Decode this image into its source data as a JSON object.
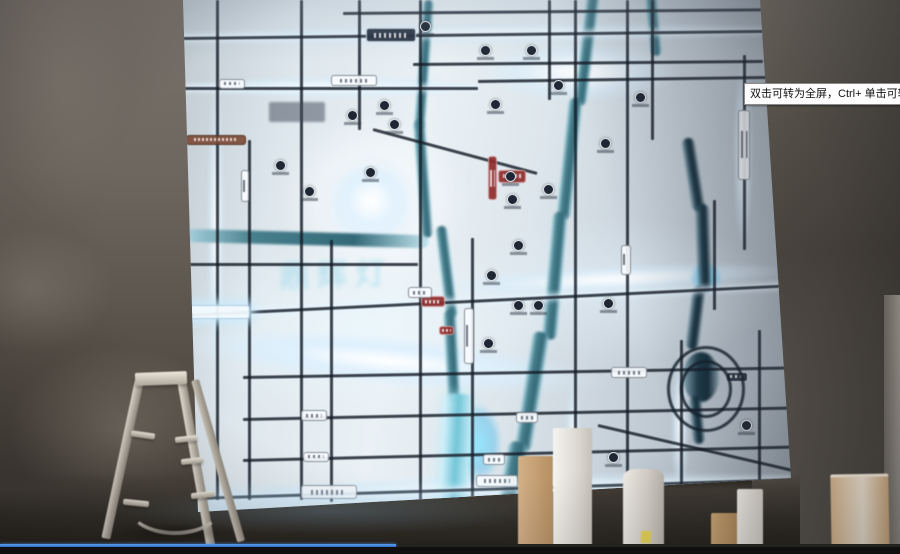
{
  "overlay": {
    "tooltip_text": "双击可转为全屏，Ctrl+ 单击可转为"
  },
  "player": {
    "progress_percent": 44,
    "progress_color": "#3f86e0"
  },
  "map": {
    "watermark": "鼎辉灯",
    "roads": [
      {
        "x": 160,
        "y": 12,
        "len": 420,
        "dir": "h",
        "rot": -0.5
      },
      {
        "x": 0,
        "y": 37,
        "len": 580,
        "dir": "h",
        "rot": -0.7,
        "glow": true
      },
      {
        "x": 230,
        "y": 63,
        "len": 350,
        "dir": "h",
        "rot": -0.5
      },
      {
        "x": 0,
        "y": 87,
        "len": 295,
        "dir": "h",
        "glow": true
      },
      {
        "x": 295,
        "y": 80,
        "len": 290,
        "dir": "h",
        "rot": -0.8
      },
      {
        "x": 0,
        "y": 263,
        "len": 235,
        "dir": "h"
      },
      {
        "x": 0,
        "y": 314,
        "len": 608,
        "dir": "h",
        "rot": -2.8,
        "glow": true
      },
      {
        "x": 60,
        "y": 376,
        "len": 548,
        "dir": "h",
        "rot": -1
      },
      {
        "x": 60,
        "y": 418,
        "len": 548,
        "dir": "h",
        "rot": -1.2
      },
      {
        "x": 60,
        "y": 459,
        "len": 548,
        "dir": "h",
        "rot": -1.4
      },
      {
        "x": 12,
        "y": 497,
        "len": 596,
        "dir": "h",
        "rot": -1.8,
        "glow": true
      },
      {
        "x": 190,
        "y": 128,
        "len": 170,
        "dir": "h",
        "rot": 15
      },
      {
        "x": 415,
        "y": 424,
        "len": 200,
        "dir": "h",
        "rot": 13
      },
      {
        "x": 33,
        "y": 0,
        "len": 500,
        "dir": "v"
      },
      {
        "x": 65,
        "y": 140,
        "len": 360,
        "dir": "v"
      },
      {
        "x": 117,
        "y": 0,
        "len": 500,
        "dir": "v"
      },
      {
        "x": 147,
        "y": 240,
        "len": 262,
        "dir": "v"
      },
      {
        "x": 175,
        "y": 0,
        "len": 130,
        "dir": "v"
      },
      {
        "x": 236,
        "y": 0,
        "len": 505,
        "dir": "v"
      },
      {
        "x": 288,
        "y": 238,
        "len": 268,
        "dir": "v"
      },
      {
        "x": 365,
        "y": 0,
        "len": 100,
        "dir": "v"
      },
      {
        "x": 391,
        "y": 0,
        "len": 505,
        "dir": "v"
      },
      {
        "x": 443,
        "y": 0,
        "len": 500,
        "dir": "v"
      },
      {
        "x": 468,
        "y": 0,
        "len": 140,
        "dir": "v"
      },
      {
        "x": 560,
        "y": 55,
        "len": 195,
        "dir": "v"
      },
      {
        "x": 530,
        "y": 200,
        "len": 110,
        "dir": "v"
      },
      {
        "x": 497,
        "y": 340,
        "len": 162,
        "dir": "v"
      },
      {
        "x": 575,
        "y": 330,
        "len": 170,
        "dir": "v"
      }
    ],
    "rivers": [
      {
        "x": 240,
        "y": 0,
        "w": 11,
        "h": 130,
        "rot": 4,
        "shade": "mid"
      },
      {
        "x": 230,
        "y": 120,
        "w": 12,
        "h": 118,
        "rot": -4,
        "shade": "mid"
      },
      {
        "x": -4,
        "y": 232,
        "w": 250,
        "h": 13,
        "rot": 1.5,
        "shade": "mid"
      },
      {
        "x": 252,
        "y": 226,
        "w": 12,
        "h": 92,
        "rot": -7,
        "shade": "mid"
      },
      {
        "x": 260,
        "y": 310,
        "w": 13,
        "h": 92,
        "rot": -3,
        "shade": "mid"
      },
      {
        "x": 262,
        "y": 394,
        "w": 28,
        "h": 118,
        "rot": 3,
        "shade": "light"
      },
      {
        "x": 404,
        "y": -6,
        "w": 13,
        "h": 112,
        "rot": 7,
        "shade": "mid"
      },
      {
        "x": 386,
        "y": 98,
        "w": 14,
        "h": 122,
        "rot": 6,
        "shade": "mid"
      },
      {
        "x": 370,
        "y": 212,
        "w": 15,
        "h": 128,
        "rot": 5,
        "shade": "mid"
      },
      {
        "x": 350,
        "y": 332,
        "w": 17,
        "h": 120,
        "rot": 9,
        "shade": "mid"
      },
      {
        "x": 326,
        "y": 442,
        "w": 20,
        "h": 72,
        "rot": 10,
        "shade": "mid"
      },
      {
        "x": 462,
        "y": -4,
        "w": 12,
        "h": 60,
        "rot": -5,
        "shade": "mid"
      },
      {
        "x": 498,
        "y": 138,
        "w": 13,
        "h": 74,
        "rot": -9,
        "shade": "dark"
      },
      {
        "x": 512,
        "y": 204,
        "w": 14,
        "h": 88,
        "rot": -2,
        "shade": "dark"
      },
      {
        "x": 510,
        "y": 286,
        "w": 13,
        "h": 64,
        "rot": 7,
        "shade": "dark"
      },
      {
        "x": 500,
        "y": 352,
        "w": 36,
        "h": 50,
        "rot": 0,
        "shade": "dark",
        "round": true
      },
      {
        "x": 506,
        "y": 396,
        "w": 12,
        "h": 48,
        "rot": -5,
        "shade": "dark"
      }
    ],
    "glows": [
      {
        "x": 138,
        "y": 154,
        "w": 100,
        "h": 98
      },
      {
        "x": 152,
        "y": 166,
        "w": 72,
        "h": 70
      },
      {
        "x": 8,
        "y": 26,
        "w": 575,
        "h": 22,
        "rot": -0.7
      },
      {
        "x": 0,
        "y": 76,
        "w": 300,
        "h": 22
      },
      {
        "x": 296,
        "y": 42,
        "w": 200,
        "h": 60
      },
      {
        "x": 250,
        "y": 274,
        "w": 360,
        "h": 28,
        "rot": -2.8
      },
      {
        "x": -6,
        "y": 316,
        "w": 430,
        "h": 50,
        "rot": 5.5
      },
      {
        "x": 50,
        "y": 328,
        "w": 310,
        "h": 36,
        "rot": 5.5
      },
      {
        "x": 0,
        "y": 484,
        "w": 604,
        "h": 28,
        "rot": -1.8
      },
      {
        "x": 24,
        "y": 80,
        "w": 18,
        "h": 300
      },
      {
        "x": 550,
        "y": 58,
        "w": 20,
        "h": 190
      },
      {
        "x": 488,
        "y": 348,
        "w": 18,
        "h": 150
      },
      {
        "x": 382,
        "y": 378,
        "w": 16,
        "h": 132
      },
      {
        "x": 272,
        "y": 406,
        "w": 46,
        "h": 74,
        "cyan": true
      },
      {
        "x": 508,
        "y": 262,
        "w": 30,
        "h": 32,
        "cyan": true
      }
    ],
    "badges": [
      {
        "x": 183,
        "y": 28,
        "w": 50,
        "h": 14,
        "kind": "dark"
      },
      {
        "x": 36,
        "y": 79,
        "w": 26,
        "h": 10,
        "kind": "white"
      },
      {
        "x": 148,
        "y": 75,
        "w": 46,
        "h": 11,
        "kind": "white"
      },
      {
        "x": 3,
        "y": 135,
        "w": 60,
        "h": 10,
        "kind": "brown"
      },
      {
        "x": 86,
        "y": 102,
        "w": 56,
        "h": 20,
        "kind": "logo"
      },
      {
        "x": 305,
        "y": 156,
        "w": 9,
        "h": 44,
        "kind": "red"
      },
      {
        "x": 315,
        "y": 170,
        "w": 28,
        "h": 13,
        "kind": "red"
      },
      {
        "x": 238,
        "y": 296,
        "w": 24,
        "h": 11,
        "kind": "red"
      },
      {
        "x": 256,
        "y": 326,
        "w": 15,
        "h": 9,
        "kind": "red"
      },
      {
        "x": 3,
        "y": 305,
        "w": 64,
        "h": 14,
        "kind": "glow"
      },
      {
        "x": 225,
        "y": 287,
        "w": 24,
        "h": 11,
        "kind": "white"
      },
      {
        "x": 428,
        "y": 367,
        "w": 36,
        "h": 11,
        "kind": "white"
      },
      {
        "x": 543,
        "y": 372,
        "w": 22,
        "h": 10,
        "kind": "dark"
      },
      {
        "x": 118,
        "y": 410,
        "w": 26,
        "h": 11,
        "kind": "white"
      },
      {
        "x": 333,
        "y": 412,
        "w": 22,
        "h": 11,
        "kind": "white"
      },
      {
        "x": 120,
        "y": 452,
        "w": 26,
        "h": 10,
        "kind": "white"
      },
      {
        "x": 300,
        "y": 454,
        "w": 22,
        "h": 11,
        "kind": "white"
      },
      {
        "x": 118,
        "y": 485,
        "w": 56,
        "h": 14,
        "kind": "white"
      },
      {
        "x": 293,
        "y": 475,
        "w": 42,
        "h": 12,
        "kind": "white"
      },
      {
        "x": 58,
        "y": 170,
        "w": 8,
        "h": 32,
        "kind": "white"
      },
      {
        "x": 281,
        "y": 308,
        "w": 10,
        "h": 56,
        "kind": "white"
      },
      {
        "x": 438,
        "y": 245,
        "w": 10,
        "h": 30,
        "kind": "white"
      },
      {
        "x": 555,
        "y": 110,
        "w": 12,
        "h": 70,
        "kind": "white"
      }
    ],
    "pois": [
      [
        92,
        160
      ],
      [
        164,
        110
      ],
      [
        196,
        100
      ],
      [
        206,
        119
      ],
      [
        121,
        186
      ],
      [
        182,
        167
      ],
      [
        307,
        99
      ],
      [
        322,
        171
      ],
      [
        324,
        194
      ],
      [
        303,
        270
      ],
      [
        330,
        300
      ],
      [
        350,
        300
      ],
      [
        360,
        184
      ],
      [
        417,
        138
      ],
      [
        425,
        452
      ],
      [
        558,
        420
      ],
      [
        297,
        45
      ],
      [
        343,
        45
      ],
      [
        237,
        21
      ],
      [
        452,
        92
      ],
      [
        330,
        240
      ],
      [
        300,
        338
      ],
      [
        420,
        298
      ],
      [
        370,
        80
      ]
    ],
    "pond_rings": [
      {
        "x": 484,
        "y": 346,
        "w": 72,
        "h": 80
      },
      {
        "x": 497,
        "y": 360,
        "w": 46,
        "h": 52
      }
    ]
  }
}
